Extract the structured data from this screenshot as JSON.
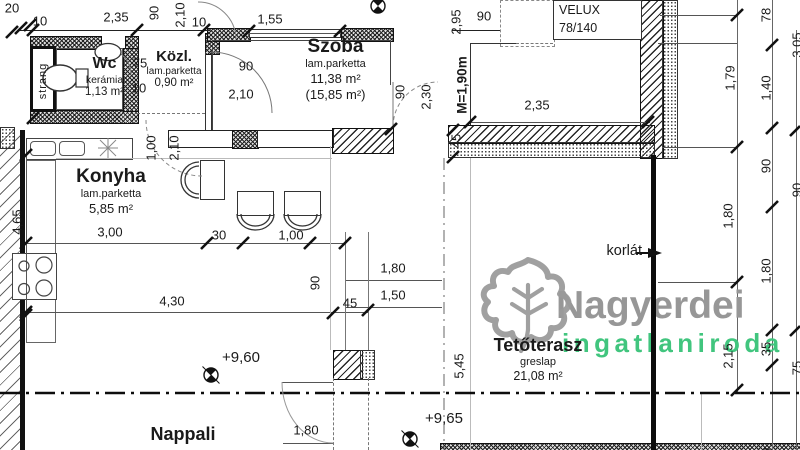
{
  "brand": {
    "name": "Nagyerdei",
    "sub": "ingatlaniroda",
    "name_color": "#979797",
    "sub_color": "#41c57e"
  },
  "rooms": {
    "wc": {
      "name": "Wc",
      "material": "kerámia",
      "area": "1,13 m²"
    },
    "kozl": {
      "name": "Közl.",
      "material": "lam.parketta",
      "area": "0,90 m²"
    },
    "szoba": {
      "name": "Szoba",
      "material": "lam.parketta",
      "area": "11,38 m²",
      "area_alt": "(15,85 m²)"
    },
    "konyha": {
      "name": "Konyha",
      "material": "lam.parketta",
      "area": "5,85 m²"
    },
    "nappali": {
      "name": "Nappali"
    },
    "tetoterasz": {
      "name": "Tetőterasz",
      "material": "greslap",
      "area": "21,08 m²"
    }
  },
  "labels": {
    "strang": "strang",
    "korlat": "korlát",
    "velux_line1": "VELUX",
    "velux_line2": "78/140",
    "height_marker": "M=1,90m",
    "level_upper": "+9,60",
    "level_lower": "+9,65"
  },
  "dimensions": [
    {
      "t": "20",
      "x": 12,
      "y": 8
    },
    {
      "t": "10",
      "x": 40,
      "y": 21
    },
    {
      "t": "2,35",
      "x": 116,
      "y": 17
    },
    {
      "t": "90",
      "x": 154,
      "y": 13,
      "r": 1
    },
    {
      "t": "2,10",
      "x": 180,
      "y": 15,
      "r": 1
    },
    {
      "t": "10",
      "x": 199,
      "y": 22
    },
    {
      "t": "1,55",
      "x": 270,
      "y": 19
    },
    {
      "t": "2,95",
      "x": 456,
      "y": 22,
      "r": 1
    },
    {
      "t": "90",
      "x": 484,
      "y": 16
    },
    {
      "t": "2,35",
      "x": 537,
      "y": 105
    },
    {
      "t": "45",
      "x": 456,
      "y": 141,
      "r": 1
    },
    {
      "t": "75",
      "x": 140,
      "y": 63
    },
    {
      "t": "10",
      "x": 139,
      "y": 88
    },
    {
      "t": "90",
      "x": 246,
      "y": 66
    },
    {
      "t": "2,10",
      "x": 241,
      "y": 94
    },
    {
      "t": "90",
      "x": 400,
      "y": 92,
      "r": 1
    },
    {
      "t": "2,30",
      "x": 426,
      "y": 97,
      "r": 1
    },
    {
      "t": "1,00",
      "x": 151,
      "y": 148,
      "r": 1
    },
    {
      "t": "2,10",
      "x": 174,
      "y": 148,
      "r": 1
    },
    {
      "t": "4,65",
      "x": 17,
      "y": 222,
      "r": 1
    },
    {
      "t": "3,00",
      "x": 110,
      "y": 232
    },
    {
      "t": "30",
      "x": 219,
      "y": 235
    },
    {
      "t": "1,00",
      "x": 291,
      "y": 235
    },
    {
      "t": "4,30",
      "x": 172,
      "y": 301
    },
    {
      "t": "90",
      "x": 315,
      "y": 283,
      "r": 1
    },
    {
      "t": "45",
      "x": 350,
      "y": 303
    },
    {
      "t": "1,80",
      "x": 393,
      "y": 268
    },
    {
      "t": "1,50",
      "x": 393,
      "y": 295
    },
    {
      "t": "1,80",
      "x": 306,
      "y": 430
    },
    {
      "t": "5,45",
      "x": 459,
      "y": 366,
      "r": 1
    },
    {
      "t": "1,79",
      "x": 730,
      "y": 78,
      "r": 1
    },
    {
      "t": "1,80",
      "x": 728,
      "y": 216,
      "r": 1
    },
    {
      "t": "2,15",
      "x": 728,
      "y": 356,
      "r": 1
    },
    {
      "t": "78",
      "x": 766,
      "y": 15,
      "r": 1
    },
    {
      "t": "1,40",
      "x": 766,
      "y": 88,
      "r": 1
    },
    {
      "t": "90",
      "x": 766,
      "y": 166,
      "r": 1
    },
    {
      "t": "1,80",
      "x": 766,
      "y": 271,
      "r": 1
    },
    {
      "t": "35",
      "x": 766,
      "y": 349,
      "r": 1
    },
    {
      "t": "90",
      "x": 766,
      "y": 455,
      "r": 1
    },
    {
      "t": "3,05",
      "x": 797,
      "y": 45,
      "r": 1
    },
    {
      "t": "90",
      "x": 797,
      "y": 190,
      "r": 1
    },
    {
      "t": "75",
      "x": 797,
      "y": 368,
      "r": 1
    }
  ]
}
